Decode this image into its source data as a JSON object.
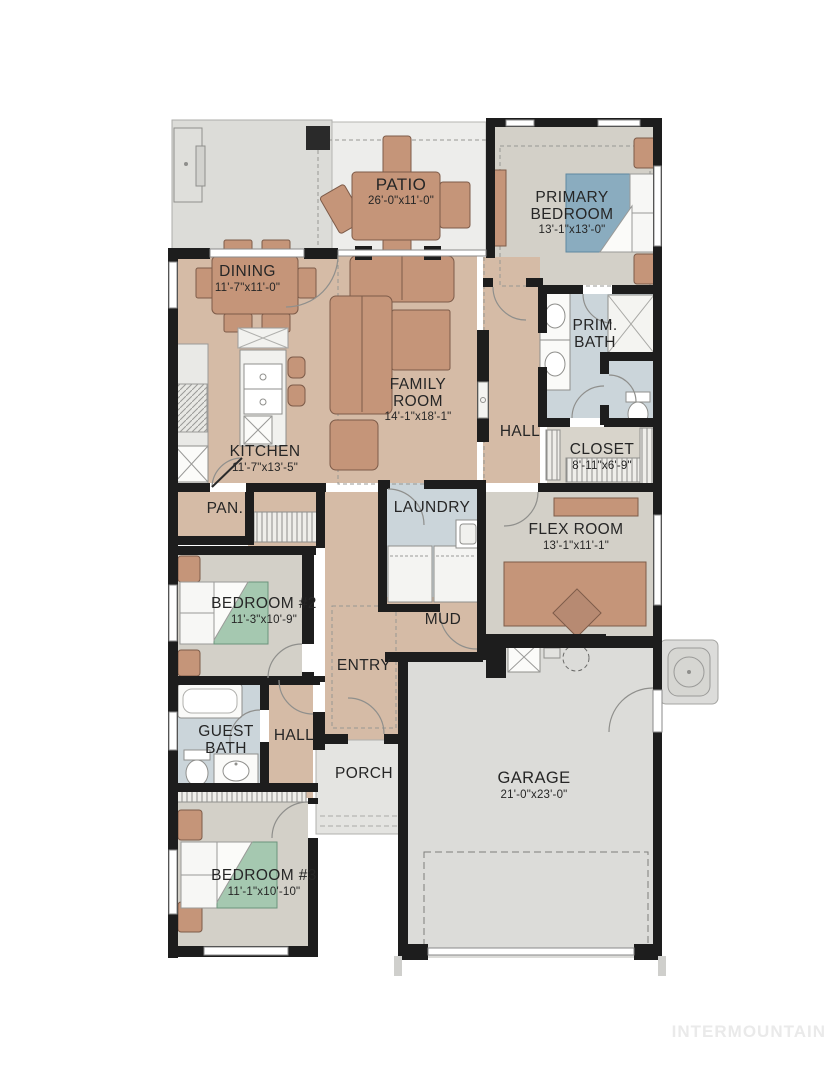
{
  "watermark": "INTERMOUNTAIN",
  "rooms": {
    "patio": {
      "name": "PATIO",
      "dims": "26'-0\"x11'-0\""
    },
    "primary_bedroom": {
      "name": "PRIMARY BEDROOM",
      "dims": "13'-1\"x13'-0\""
    },
    "dining": {
      "name": "DINING",
      "dims": "11'-7\"x11'-0\""
    },
    "family_room": {
      "name": "FAMILY ROOM",
      "dims": "14'-1\"x18'-1\""
    },
    "prim_bath": {
      "name": "PRIM. BATH",
      "dims": ""
    },
    "hall_upper": {
      "name": "HALL",
      "dims": ""
    },
    "closet": {
      "name": "CLOSET",
      "dims": "8'-11\"x6'-9\""
    },
    "kitchen": {
      "name": "KITCHEN",
      "dims": "11'-7\"x13'-5\""
    },
    "pantry": {
      "name": "PAN.",
      "dims": ""
    },
    "laundry": {
      "name": "LAUNDRY",
      "dims": ""
    },
    "flex_room": {
      "name": "FLEX ROOM",
      "dims": "13'-1\"x11'-1\""
    },
    "bedroom_2": {
      "name": "BEDROOM #2",
      "dims": "11'-3\"x10'-9\""
    },
    "mud": {
      "name": "MUD",
      "dims": ""
    },
    "entry": {
      "name": "ENTRY",
      "dims": ""
    },
    "guest_bath": {
      "name": "GUEST BATH",
      "dims": ""
    },
    "hall_lower": {
      "name": "HALL",
      "dims": ""
    },
    "porch": {
      "name": "PORCH",
      "dims": ""
    },
    "garage": {
      "name": "GARAGE",
      "dims": "21'-0\"x23'-0\""
    },
    "bedroom_3": {
      "name": "BEDROOM #3",
      "dims": "11'-1\"x10'-10\""
    }
  },
  "colors": {
    "floor_tan": "#d5bba6",
    "floor_gray": "#d3d0c8",
    "floor_blue": "#cbd5da",
    "concrete": "#dcdcd8",
    "patio_light": "#ededeb",
    "bed_green": "#a5c8b0",
    "bed_blue": "#8aacbf",
    "furniture_brown": "#c59579",
    "wall_black": "#1d1d1d"
  }
}
